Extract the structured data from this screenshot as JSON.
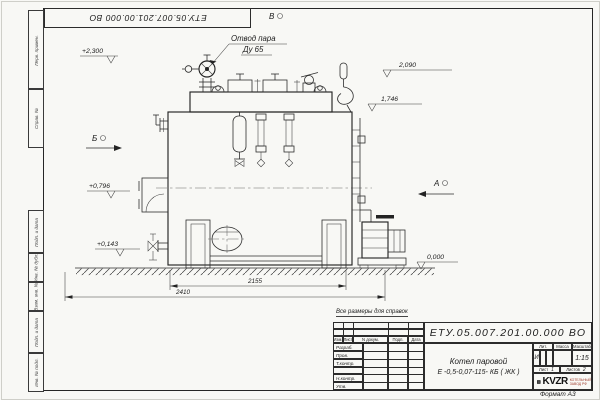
{
  "frame": {
    "top_designation": "ЕТУ.05.007.201.00.000 ВО",
    "format_note": "Формат А3",
    "margin_labels": [
      "Перв. примен.",
      "Справ. №",
      "Подп. и дата",
      "Инв. № дубл.",
      "Взам. инв. №",
      "Подп. и дата",
      "Инв. № подл."
    ]
  },
  "drawing": {
    "callout_line1": "Отвод пара",
    "callout_line2": "Ду 65",
    "view_labels": {
      "a": "А",
      "b": "Б",
      "v": "В"
    },
    "elevations": {
      "top": "+2,300",
      "e2090": "2,090",
      "e1746": "1,746",
      "e0796": "+0,796",
      "e0143": "+0,143",
      "zero": "0,000"
    },
    "dimensions": {
      "inner": "2155",
      "outer": "2410"
    }
  },
  "title_block": {
    "reference_note": "Все размеры для справок",
    "designation": "ЕТУ.05.007.201.00.000  ВО",
    "name_line1": "Котел паровой",
    "name_line2": "Е -0,5-0,07-115- КБ ( ЖК )",
    "rev_header": [
      "Изм.",
      "Лист",
      "N докум.",
      "Подп.",
      "Дата"
    ],
    "sig_labels": [
      "Разраб.",
      "Пров.",
      "Т.контр.",
      "",
      "Н.контр.",
      "Утв."
    ],
    "lit_header": "Лит.",
    "mass_header": "Масса",
    "scale_header": "Масштаб",
    "lit_value": "И",
    "scale_value": "1:15",
    "sheet_label": "Лист",
    "sheet_value": "1",
    "sheets_label": "Листов",
    "sheets_value": "2",
    "logo": {
      "text": "KVZR",
      "sub1": "КОТЕЛЬНЫЙ",
      "sub2": "ЗАВОД РФ"
    },
    "accent_color": "#a03a2a",
    "line_color": "#2c2c2c"
  }
}
